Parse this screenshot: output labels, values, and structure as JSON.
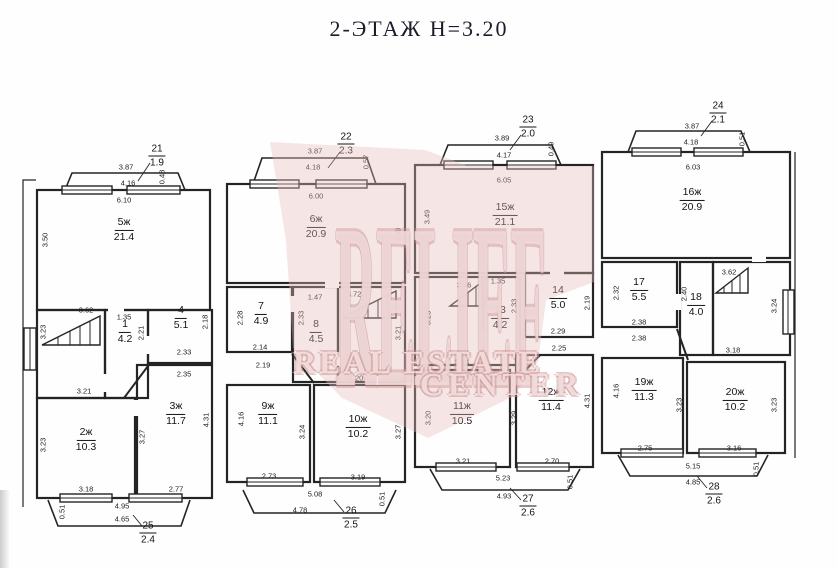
{
  "title": "2-ЭТАЖ Н=3.20",
  "watermark": {
    "brand": "RELIEF",
    "line1": "REAL ESTATE",
    "line2": "CENTER"
  },
  "plan": {
    "floor_height": "3.20",
    "rooms": [
      {
        "num": "5ж",
        "area": "21.4",
        "x": 124,
        "y": 230
      },
      {
        "num": "1",
        "area": "4.2",
        "x": 125,
        "y": 332
      },
      {
        "num": "4",
        "area": "5.1",
        "x": 181,
        "y": 318
      },
      {
        "num": "2ж",
        "area": "10.3",
        "x": 86,
        "y": 440
      },
      {
        "num": "3ж",
        "area": "11.7",
        "x": 176,
        "y": 414
      },
      {
        "num": "6ж",
        "area": "20.9",
        "x": 316,
        "y": 227
      },
      {
        "num": "7",
        "area": "4.9",
        "x": 261,
        "y": 314
      },
      {
        "num": "8",
        "area": "4.5",
        "x": 316,
        "y": 332
      },
      {
        "num": "9ж",
        "area": "11.1",
        "x": 268,
        "y": 414
      },
      {
        "num": "10ж",
        "area": "10.2",
        "x": 358,
        "y": 427
      },
      {
        "num": "15ж",
        "area": "21.1",
        "x": 505,
        "y": 215
      },
      {
        "num": "13",
        "area": "4.2",
        "x": 500,
        "y": 318
      },
      {
        "num": "14",
        "area": "5.0",
        "x": 558,
        "y": 298
      },
      {
        "num": "11ж",
        "area": "10.5",
        "x": 462,
        "y": 414
      },
      {
        "num": "12ж",
        "area": "11.4",
        "x": 551,
        "y": 400
      },
      {
        "num": "16ж",
        "area": "20.9",
        "x": 692,
        "y": 200
      },
      {
        "num": "17",
        "area": "5.5",
        "x": 639,
        "y": 290
      },
      {
        "num": "18",
        "area": "4.0",
        "x": 696,
        "y": 305
      },
      {
        "num": "19ж",
        "area": "11.3",
        "x": 644,
        "y": 390
      },
      {
        "num": "20ж",
        "area": "10.2",
        "x": 735,
        "y": 400
      }
    ],
    "balconies": [
      {
        "num": "21",
        "area": "1.9",
        "x": 157,
        "y": 156
      },
      {
        "num": "22",
        "area": "2.3",
        "x": 346,
        "y": 144
      },
      {
        "num": "23",
        "area": "2.0",
        "x": 528,
        "y": 127
      },
      {
        "num": "24",
        "area": "2.1",
        "x": 718,
        "y": 113
      },
      {
        "num": "25",
        "area": "2.4",
        "x": 148,
        "y": 533
      },
      {
        "num": "26",
        "area": "2.5",
        "x": 351,
        "y": 518
      },
      {
        "num": "27",
        "area": "2.6",
        "x": 528,
        "y": 506
      },
      {
        "num": "28",
        "area": "2.6",
        "x": 714,
        "y": 494
      }
    ],
    "dims": [
      {
        "t": "3.87",
        "x": 126,
        "y": 167,
        "v": 0
      },
      {
        "t": "4.16",
        "x": 128,
        "y": 183,
        "v": 0
      },
      {
        "t": "0.48",
        "x": 162,
        "y": 177,
        "v": 1
      },
      {
        "t": "6.10",
        "x": 124,
        "y": 200,
        "v": 0
      },
      {
        "t": "3.50",
        "x": 45,
        "y": 240,
        "v": 1
      },
      {
        "t": "3.62",
        "x": 86,
        "y": 310,
        "v": 0
      },
      {
        "t": "1.35",
        "x": 124,
        "y": 317,
        "v": 0
      },
      {
        "t": "2.21",
        "x": 141,
        "y": 333,
        "v": 1
      },
      {
        "t": "2.18",
        "x": 205,
        "y": 322,
        "v": 1
      },
      {
        "t": "2.33",
        "x": 184,
        "y": 352,
        "v": 0
      },
      {
        "t": "2.35",
        "x": 184,
        "y": 374,
        "v": 0
      },
      {
        "t": "3.23",
        "x": 43,
        "y": 332,
        "v": 1
      },
      {
        "t": "3.21",
        "x": 84,
        "y": 391,
        "v": 0
      },
      {
        "t": "3.23",
        "x": 43,
        "y": 445,
        "v": 1
      },
      {
        "t": "3.27",
        "x": 142,
        "y": 437,
        "v": 1
      },
      {
        "t": "4.31",
        "x": 206,
        "y": 420,
        "v": 1
      },
      {
        "t": "3.18",
        "x": 86,
        "y": 489,
        "v": 0
      },
      {
        "t": "2.77",
        "x": 176,
        "y": 489,
        "v": 0
      },
      {
        "t": "4.95",
        "x": 122,
        "y": 506,
        "v": 0
      },
      {
        "t": "4.65",
        "x": 122,
        "y": 519,
        "v": 0
      },
      {
        "t": "0.51",
        "x": 62,
        "y": 512,
        "v": 1
      },
      {
        "t": "3.87",
        "x": 315,
        "y": 151,
        "v": 0
      },
      {
        "t": "4.18",
        "x": 313,
        "y": 167,
        "v": 0
      },
      {
        "t": "0.57",
        "x": 366,
        "y": 162,
        "v": 1
      },
      {
        "t": "6.00",
        "x": 316,
        "y": 196,
        "v": 0
      },
      {
        "t": "3.49",
        "x": 398,
        "y": 235,
        "v": 1
      },
      {
        "t": "2.28",
        "x": 240,
        "y": 318,
        "v": 1
      },
      {
        "t": "1.47",
        "x": 315,
        "y": 297,
        "v": 0
      },
      {
        "t": "2.33",
        "x": 301,
        "y": 318,
        "v": 1
      },
      {
        "t": "3.72",
        "x": 354,
        "y": 294,
        "v": 0
      },
      {
        "t": "3.21",
        "x": 398,
        "y": 333,
        "v": 1
      },
      {
        "t": "2.14",
        "x": 260,
        "y": 347,
        "v": 0
      },
      {
        "t": "2.19",
        "x": 263,
        "y": 365,
        "v": 0
      },
      {
        "t": "3.20",
        "x": 356,
        "y": 378,
        "v": 0
      },
      {
        "t": "4.16",
        "x": 241,
        "y": 419,
        "v": 1
      },
      {
        "t": "3.24",
        "x": 302,
        "y": 432,
        "v": 1
      },
      {
        "t": "3.27",
        "x": 398,
        "y": 432,
        "v": 1
      },
      {
        "t": "2.73",
        "x": 269,
        "y": 476,
        "v": 0
      },
      {
        "t": "3.19",
        "x": 358,
        "y": 477,
        "v": 0
      },
      {
        "t": "5.08",
        "x": 315,
        "y": 494,
        "v": 0
      },
      {
        "t": "4.78",
        "x": 300,
        "y": 510,
        "v": 0
      },
      {
        "t": "0.51",
        "x": 382,
        "y": 499,
        "v": 1
      },
      {
        "t": "3.89",
        "x": 502,
        "y": 138,
        "v": 0
      },
      {
        "t": "4.17",
        "x": 504,
        "y": 155,
        "v": 0
      },
      {
        "t": "0.49",
        "x": 551,
        "y": 149,
        "v": 1
      },
      {
        "t": "6.05",
        "x": 504,
        "y": 180,
        "v": 0
      },
      {
        "t": "3.49",
        "x": 427,
        "y": 217,
        "v": 1
      },
      {
        "t": "3.46",
        "x": 464,
        "y": 285,
        "v": 0
      },
      {
        "t": "1.35",
        "x": 498,
        "y": 281,
        "v": 0
      },
      {
        "t": "2.33",
        "x": 514,
        "y": 306,
        "v": 1
      },
      {
        "t": "2.19",
        "x": 587,
        "y": 303,
        "v": 1
      },
      {
        "t": "2.29",
        "x": 558,
        "y": 331,
        "v": 0
      },
      {
        "t": "2.25",
        "x": 559,
        "y": 348,
        "v": 0
      },
      {
        "t": "3.23",
        "x": 428,
        "y": 318,
        "v": 1
      },
      {
        "t": "3.24",
        "x": 462,
        "y": 362,
        "v": 0
      },
      {
        "t": "3.20",
        "x": 428,
        "y": 418,
        "v": 1
      },
      {
        "t": "3.29",
        "x": 514,
        "y": 418,
        "v": 1
      },
      {
        "t": "4.31",
        "x": 587,
        "y": 401,
        "v": 1
      },
      {
        "t": "3.21",
        "x": 463,
        "y": 461,
        "v": 0
      },
      {
        "t": "2.70",
        "x": 552,
        "y": 461,
        "v": 0
      },
      {
        "t": "5.23",
        "x": 503,
        "y": 478,
        "v": 0
      },
      {
        "t": "4.93",
        "x": 504,
        "y": 496,
        "v": 0
      },
      {
        "t": "0.51",
        "x": 570,
        "y": 482,
        "v": 1
      },
      {
        "t": "3.87",
        "x": 692,
        "y": 126,
        "v": 0
      },
      {
        "t": "4.18",
        "x": 691,
        "y": 142,
        "v": 0
      },
      {
        "t": "0.51",
        "x": 742,
        "y": 139,
        "v": 1
      },
      {
        "t": "6.03",
        "x": 693,
        "y": 167,
        "v": 0
      },
      {
        "t": "2.32",
        "x": 616,
        "y": 293,
        "v": 1
      },
      {
        "t": "2.38",
        "x": 639,
        "y": 322,
        "v": 0
      },
      {
        "t": "2.38",
        "x": 639,
        "y": 338,
        "v": 0
      },
      {
        "t": "2.40",
        "x": 684,
        "y": 294,
        "v": 1
      },
      {
        "t": "3.62",
        "x": 729,
        "y": 272,
        "v": 0
      },
      {
        "t": "3.24",
        "x": 774,
        "y": 306,
        "v": 1
      },
      {
        "t": "3.18",
        "x": 733,
        "y": 350,
        "v": 0
      },
      {
        "t": "4.16",
        "x": 616,
        "y": 391,
        "v": 1
      },
      {
        "t": "3.23",
        "x": 679,
        "y": 405,
        "v": 1
      },
      {
        "t": "2.75",
        "x": 645,
        "y": 448,
        "v": 0
      },
      {
        "t": "3.23",
        "x": 774,
        "y": 405,
        "v": 1
      },
      {
        "t": "3.16",
        "x": 734,
        "y": 448,
        "v": 0
      },
      {
        "t": "5.15",
        "x": 693,
        "y": 466,
        "v": 0
      },
      {
        "t": "4.85",
        "x": 693,
        "y": 482,
        "v": 0
      },
      {
        "t": "0.51",
        "x": 756,
        "y": 469,
        "v": 1
      }
    ]
  }
}
